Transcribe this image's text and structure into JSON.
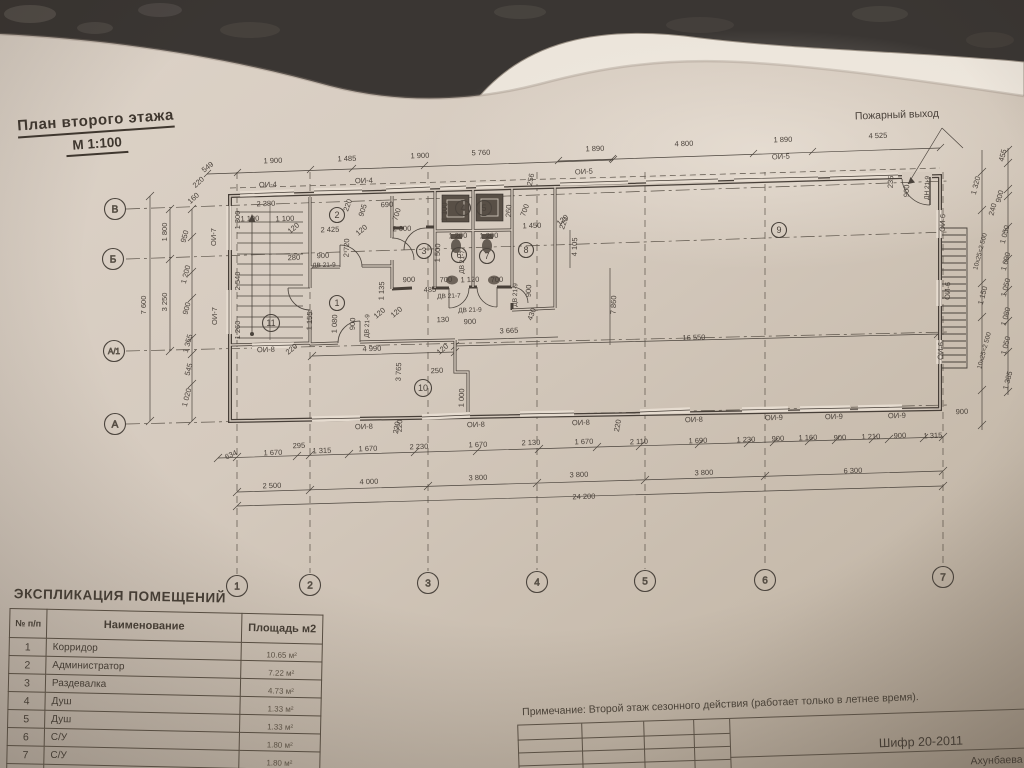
{
  "colors": {
    "ink": "#49413a",
    "paper": "#d5cabe",
    "fixture": "#5a5148"
  },
  "title": {
    "line1": "План  второго  этажа",
    "line2": "М 1:100"
  },
  "plan": {
    "labels": [
      [
        "549",
        209,
        169,
        -38
      ],
      [
        "1 900",
        273,
        163,
        -2
      ],
      [
        "1 485",
        347,
        161,
        -2
      ],
      [
        "1 900",
        420,
        158,
        -2
      ],
      [
        "5 760",
        481,
        155,
        -2
      ],
      [
        "1 890",
        595,
        151,
        -2
      ],
      [
        "4 800",
        684,
        146,
        -2
      ],
      [
        "1 890",
        783,
        142,
        -2
      ],
      [
        "4 525",
        878,
        138,
        -2
      ],
      [
        "Пожарный выход",
        897,
        118,
        -2,
        10.5
      ],
      [
        "220",
        200,
        184,
        -42
      ],
      [
        "160",
        195,
        200,
        -42
      ],
      [
        "ОИ-4",
        268,
        187,
        -2
      ],
      [
        "ОИ-4",
        364,
        183,
        -2
      ],
      [
        "ОИ-5",
        584,
        174,
        -3
      ],
      [
        "ОИ-5",
        781,
        159,
        -3
      ],
      [
        "256",
        533,
        180,
        -78
      ],
      [
        "220",
        350,
        206,
        -70
      ],
      [
        "2 380",
        266,
        206,
        -2
      ],
      [
        "1 100",
        250,
        221,
        -2
      ],
      [
        "1 100",
        285,
        221,
        -2
      ],
      [
        "120",
        295,
        230,
        -40
      ],
      [
        "1 300",
        240,
        220,
        -90
      ],
      [
        "2 540",
        240,
        281,
        -90
      ],
      [
        "1 260",
        240,
        330,
        -90
      ],
      [
        "ОИ-7",
        216,
        237,
        -90
      ],
      [
        "ОИ-7",
        217,
        316,
        -90
      ],
      [
        "280",
        294,
        260,
        -2
      ],
      [
        "900",
        323,
        258,
        -2
      ],
      [
        "ДВ 21-9",
        324,
        267,
        -2,
        6.5
      ],
      [
        "2 425",
        330,
        232,
        -2
      ],
      [
        "2 720",
        349,
        248,
        -88
      ],
      [
        "120",
        363,
        232,
        -40
      ],
      [
        "905",
        365,
        211,
        -72
      ],
      [
        "690",
        387,
        207,
        -2
      ],
      [
        "700",
        399,
        215,
        -72
      ],
      [
        "2 000",
        402,
        231,
        -2
      ],
      [
        "1 155",
        312,
        321,
        -88
      ],
      [
        "1 080",
        337,
        324,
        -88
      ],
      [
        "900",
        355,
        324,
        -88
      ],
      [
        "ДВ 21-9",
        369,
        326,
        -88,
        6.5
      ],
      [
        "1 135",
        384,
        291,
        -88
      ],
      [
        "120",
        381,
        315,
        -40
      ],
      [
        "120",
        398,
        314,
        -40
      ],
      [
        "1 100",
        447,
        212,
        -88
      ],
      [
        "260",
        511,
        211,
        -88
      ],
      [
        "700",
        527,
        211,
        -70
      ],
      [
        "1 450",
        532,
        228,
        -2
      ],
      [
        "120",
        564,
        222,
        -40
      ],
      [
        "1 200",
        458,
        238,
        -2
      ],
      [
        "1 200",
        489,
        238,
        -2
      ],
      [
        "1 500",
        440,
        253,
        -88
      ],
      [
        "ДВ 21-7",
        464,
        262,
        -88,
        6.5
      ],
      [
        "ДВ 21-9",
        517,
        295,
        -88,
        6.5
      ],
      [
        "900",
        531,
        291,
        -88
      ],
      [
        "900",
        409,
        282,
        -2
      ],
      [
        "700",
        446,
        282,
        -2
      ],
      [
        "1 120",
        470,
        282,
        -2
      ],
      [
        "700",
        497,
        282,
        -2
      ],
      [
        "485",
        430,
        292,
        -2
      ],
      [
        "ДВ 21-7",
        449,
        298,
        -2,
        6.5
      ],
      [
        "ДВ 21-9",
        470,
        312,
        -2,
        6.5
      ],
      [
        "130",
        443,
        322,
        -2
      ],
      [
        "900",
        470,
        324,
        -2
      ],
      [
        "430",
        534,
        315,
        -70
      ],
      [
        "220",
        566,
        224,
        -70
      ],
      [
        "4 105",
        577,
        247,
        -88
      ],
      [
        "7 860",
        616,
        305,
        -88
      ],
      [
        "16 550",
        694,
        340,
        -2
      ],
      [
        "3 665",
        509,
        333,
        -2
      ],
      [
        "4 990",
        372,
        351,
        -2
      ],
      [
        "120",
        444,
        351,
        -40
      ],
      [
        "3 765",
        401,
        372,
        -88
      ],
      [
        "250",
        437,
        373,
        -2
      ],
      [
        "1 000",
        464,
        398,
        -88
      ],
      [
        "220",
        402,
        426,
        -88
      ],
      [
        "ОИ-8",
        266,
        352,
        -2
      ],
      [
        "220",
        293,
        351,
        -40
      ],
      [
        "ОИ-8",
        364,
        429,
        -2
      ],
      [
        "220",
        399,
        428,
        -80
      ],
      [
        "ОИ-8",
        476,
        427,
        -2
      ],
      [
        "ОИ-8",
        581,
        425,
        -2
      ],
      [
        "220",
        620,
        426,
        -80
      ],
      [
        "ОИ-8",
        694,
        422,
        -2
      ],
      [
        "ОИ-9",
        774,
        420,
        -2
      ],
      [
        "ОИ-9",
        834,
        419,
        -2
      ],
      [
        "ОИ-9",
        897,
        418,
        -2
      ],
      [
        "900",
        962,
        414,
        -2
      ],
      [
        "634",
        232,
        457,
        -25
      ],
      [
        "1 670",
        273,
        455,
        -2
      ],
      [
        "295",
        299,
        448,
        -2
      ],
      [
        "1 315",
        322,
        453,
        -2
      ],
      [
        "1 670",
        368,
        451,
        -2
      ],
      [
        "2 230",
        419,
        449,
        -2
      ],
      [
        "1 670",
        478,
        447,
        -2
      ],
      [
        "2 130",
        531,
        445,
        -2
      ],
      [
        "1 670",
        584,
        444,
        -2
      ],
      [
        "2 110",
        639,
        444,
        -2
      ],
      [
        "1 690",
        698,
        443,
        -2
      ],
      [
        "1 230",
        746,
        442,
        -2
      ],
      [
        "900",
        778,
        441,
        -2
      ],
      [
        "1 160",
        808,
        440,
        -2
      ],
      [
        "900",
        840,
        440,
        -2
      ],
      [
        "1 210",
        871,
        439,
        -2
      ],
      [
        "900",
        900,
        438,
        -2
      ],
      [
        "1 315",
        933,
        438,
        -2
      ],
      [
        "2 500",
        272,
        488,
        -2
      ],
      [
        "4 000",
        369,
        484,
        -2
      ],
      [
        "3 800",
        478,
        480,
        -2
      ],
      [
        "3 800",
        579,
        477,
        -2
      ],
      [
        "3 800",
        704,
        475,
        -2
      ],
      [
        "6 300",
        853,
        473,
        -2
      ],
      [
        "24 200",
        584,
        499,
        -2
      ],
      [
        "7 600",
        146,
        305,
        -90
      ],
      [
        "1 800",
        167,
        232,
        -90
      ],
      [
        "3 250",
        167,
        302,
        -90
      ],
      [
        "950",
        187,
        237,
        -75
      ],
      [
        "1 200",
        188,
        275,
        -75
      ],
      [
        "900",
        189,
        309,
        -75
      ],
      [
        "1 355",
        190,
        344,
        -75
      ],
      [
        "545",
        191,
        370,
        -75
      ],
      [
        "1 020",
        189,
        398,
        -75
      ],
      [
        "455",
        1005,
        156,
        -75
      ],
      [
        "1 320",
        978,
        186,
        -75
      ],
      [
        "900",
        1002,
        197,
        -75
      ],
      [
        "240",
        995,
        210,
        -75
      ],
      [
        "10х25=2 500",
        982,
        252,
        -75,
        6.5
      ],
      [
        "1 050",
        1007,
        235,
        -75
      ],
      [
        "1 090",
        1008,
        262,
        -75
      ],
      [
        "1 150",
        985,
        296,
        -75
      ],
      [
        "1 050",
        1008,
        288,
        -75
      ],
      [
        "1 080",
        1008,
        317,
        -75
      ],
      [
        "10х25=2 500",
        986,
        351,
        -75,
        6.5
      ],
      [
        "1 050",
        1008,
        346,
        -75
      ],
      [
        "1 385",
        1010,
        381,
        -75
      ],
      [
        "235",
        893,
        182,
        -88
      ],
      [
        "900",
        909,
        191,
        -88
      ],
      [
        "ДН 21-9",
        929,
        188,
        -88,
        6.5
      ],
      [
        "ОИ-6",
        945,
        223,
        -88
      ],
      [
        "ОИ-6",
        950,
        291,
        -88
      ],
      [
        "ОИ-6",
        943,
        351,
        -88
      ]
    ],
    "rooms": [
      [
        "1",
        337,
        303
      ],
      [
        "2",
        337,
        215
      ],
      [
        "3",
        424,
        251
      ],
      [
        "4",
        463,
        208
      ],
      [
        "5",
        484,
        208
      ],
      [
        "6",
        459,
        255
      ],
      [
        "7",
        487,
        256
      ],
      [
        "8",
        526,
        250
      ],
      [
        "9",
        779,
        230
      ],
      [
        "10",
        423,
        388
      ],
      [
        "11",
        271,
        323
      ]
    ],
    "cols": [
      [
        "1",
        237,
        586
      ],
      [
        "2",
        310,
        585
      ],
      [
        "3",
        428,
        583
      ],
      [
        "4",
        537,
        582
      ],
      [
        "5",
        645,
        581
      ],
      [
        "6",
        765,
        580
      ],
      [
        "7",
        943,
        577
      ]
    ],
    "rows": [
      [
        "В",
        115,
        209,
        181
      ],
      [
        "Б",
        113,
        259,
        232
      ],
      [
        "А/1",
        114,
        351,
        332
      ],
      [
        "А",
        115,
        424,
        405
      ]
    ]
  },
  "table": {
    "title": "ЭКСПЛИКАЦИЯ ПОМЕЩЕНИЙ",
    "headers": {
      "num": "№ п/п",
      "name": "Наименование",
      "area": "Площадь м2"
    },
    "rows": [
      [
        "1",
        "Корридор",
        "10.65 м²"
      ],
      [
        "2",
        "Администратор",
        "7.22 м²"
      ],
      [
        "3",
        "Раздевалка",
        "4.73 м²"
      ],
      [
        "4",
        "Душ",
        "1.33 м²"
      ],
      [
        "5",
        "Душ",
        "1.33 м²"
      ],
      [
        "6",
        "С/У",
        "1.80 м²"
      ],
      [
        "7",
        "С/У",
        "1.80 м²"
      ],
      [
        "8",
        "Раздевалка",
        "1.80 м²"
      ]
    ]
  },
  "note": {
    "text": "Примечание: Второй этаж сезонного действия (работает только в летнее время)."
  },
  "titleblock": {
    "code": "Шифр 20-2011",
    "name": "Ахунбаева"
  }
}
